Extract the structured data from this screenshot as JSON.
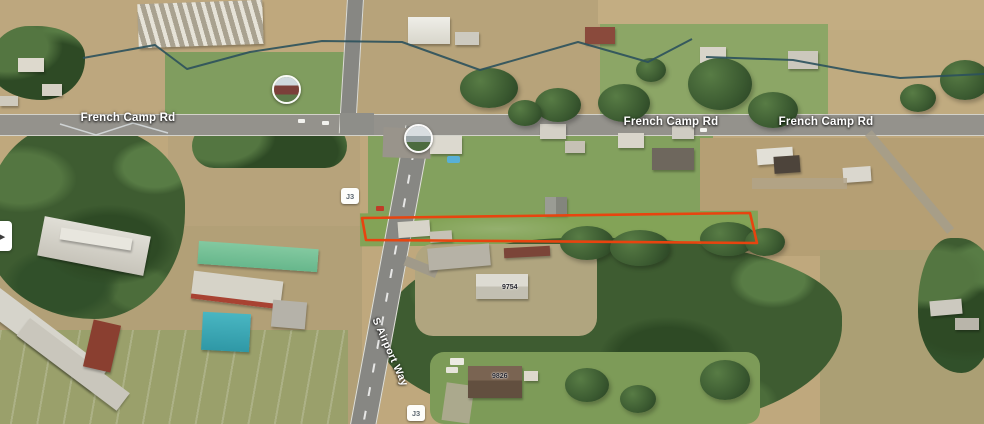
{
  "labels": {
    "road_labels": [
      "French Camp Rd",
      "French Camp Rd",
      "French Camp Rd"
    ],
    "rotated_road_label": "S Airport Way",
    "route_shields": [
      "J3",
      "J3"
    ],
    "address_labels": [
      "9754",
      "9826"
    ]
  },
  "annotations": {
    "property_outline": {
      "color": "#e8440f",
      "points": "362,218 750,213 757,243 366,240"
    }
  },
  "map_features": {
    "fence_line_color": "#2b515c",
    "fence_lines": [
      "83,58 155,45 187,69 250,52 322,41 402,42 480,70 578,42 648,62 692,39",
      "706,57 793,60 858,72 900,78 984,74"
    ],
    "canal_line": {
      "color": "#dde4e6",
      "points": "60,124 96,135 133,123 168,133"
    }
  },
  "icons": {
    "carousel_arrow": "▸"
  }
}
